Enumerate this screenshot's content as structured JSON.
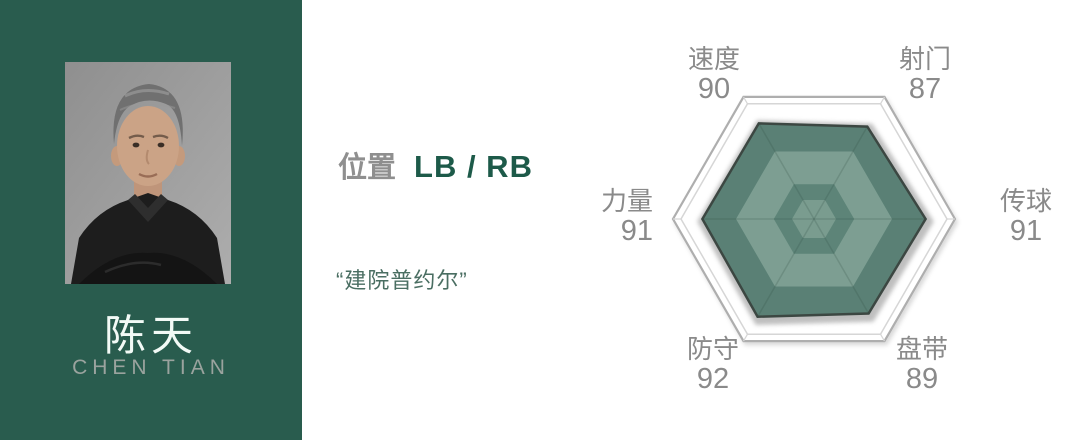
{
  "player": {
    "name_cn": "陈天",
    "name_en": "CHEN TIAN",
    "position_label": "位置",
    "position_value": "LB / RB",
    "quote": "“建院普约尔”"
  },
  "chart_data": {
    "type": "radar",
    "title": "",
    "categories": [
      "速度",
      "射门",
      "传球",
      "盘带",
      "防守",
      "力量"
    ],
    "values": [
      90,
      87,
      91,
      89,
      92,
      91
    ],
    "axis_range": [
      0,
      115
    ],
    "grid": "hexagonal",
    "legend": "none"
  },
  "colors": {
    "panel_green": "#295c4e",
    "name_white": "#f2faf6",
    "name_en_grey": "#9aa39e",
    "label_grey": "#8f8f8f",
    "stat_grey": "#8a8a8a",
    "position_green": "#1d5a49",
    "quote_green": "#4a6e62",
    "chart": {
      "fill_base": "#5a8075",
      "fill_light": "#7d9e92",
      "fill_mid": "#5d8478",
      "fill_center": "#7a9c8f",
      "outline_dark": "#3c4742",
      "frame_grey": "#aeaeae",
      "frame_light": "#d6d6d6",
      "shadow_grey": "#b8b8b8"
    }
  }
}
